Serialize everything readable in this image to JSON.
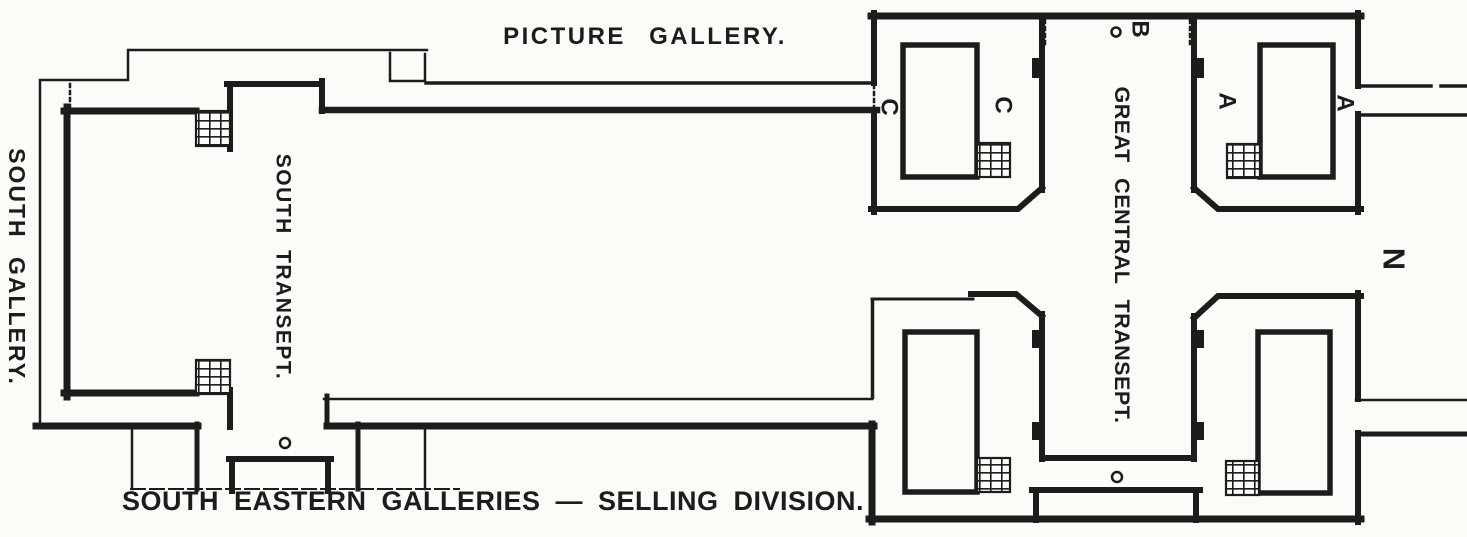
{
  "labels": {
    "picture_gallery": "PICTURE GALLERY.",
    "south_gallery": "SOUTH GALLERY.",
    "south_transept": "SOUTH TRANSEPT.",
    "great_central_transept": "GREAT CENTRAL TRANSEPT.",
    "south_eastern_galleries": "SOUTH EASTERN GALLERIES — SELLING DIVISION."
  },
  "markers": {
    "c_outer": "C",
    "c_inner": "C",
    "b_entrance": "B",
    "a_inner": "A",
    "a_outer": "A",
    "compass_north": "N"
  },
  "icons": {
    "staircase": "hatched-grid",
    "entrance_marker": "small-circle",
    "opening_marker": "dotted-line"
  },
  "colors": {
    "ink": "#1c1c1c",
    "paper": "#fcfbf8"
  }
}
